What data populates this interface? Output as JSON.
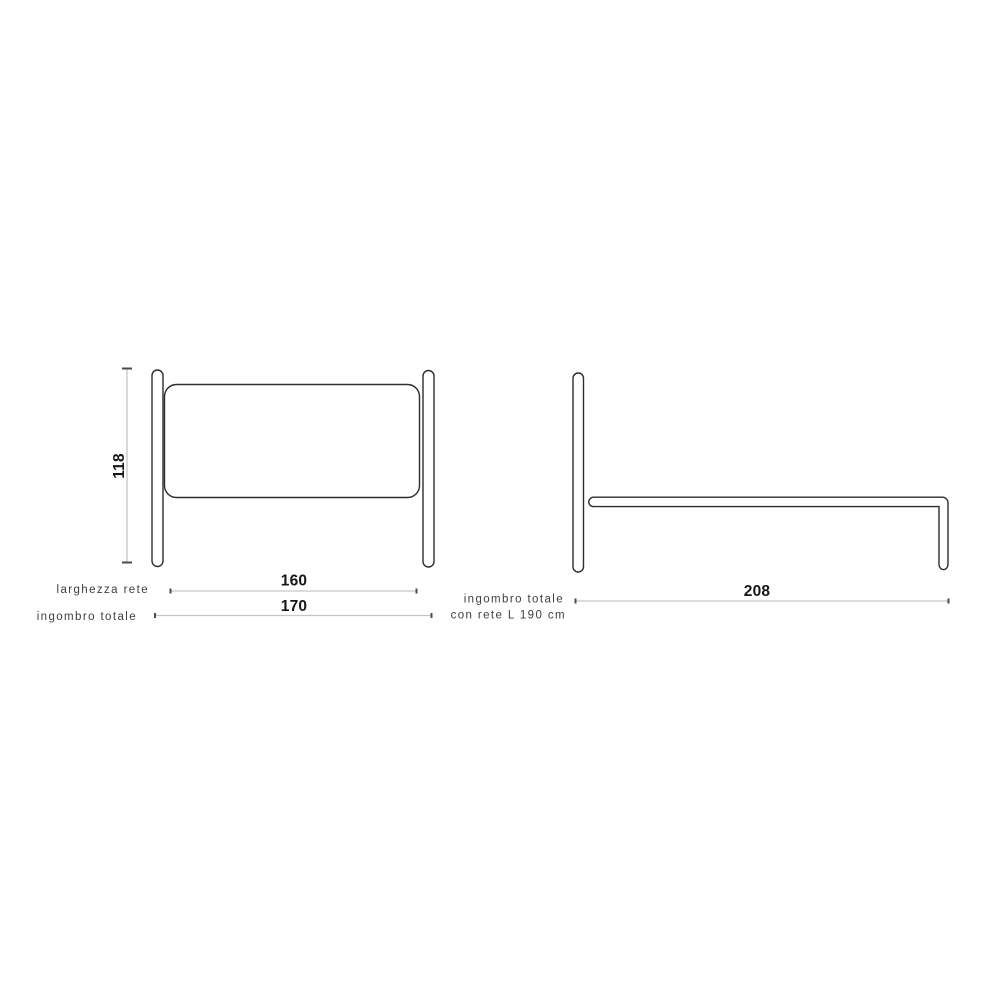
{
  "colors": {
    "background": "#ffffff",
    "outline": "#2d2d2d",
    "dimension_line": "#c6c6c6",
    "dimension_tick": "#4b4b4b",
    "label_text": "#3e3e3e",
    "number_text": "#161616"
  },
  "front_view": {
    "height_dimension": {
      "value": "118"
    },
    "dimensions": [
      {
        "label": "larghezza rete",
        "value": "160"
      },
      {
        "label": "ingombro totale",
        "value": "170"
      }
    ]
  },
  "side_view": {
    "dimension": {
      "label_line1": "ingombro totale",
      "label_line2": "con rete L 190 cm",
      "value": "208"
    }
  }
}
